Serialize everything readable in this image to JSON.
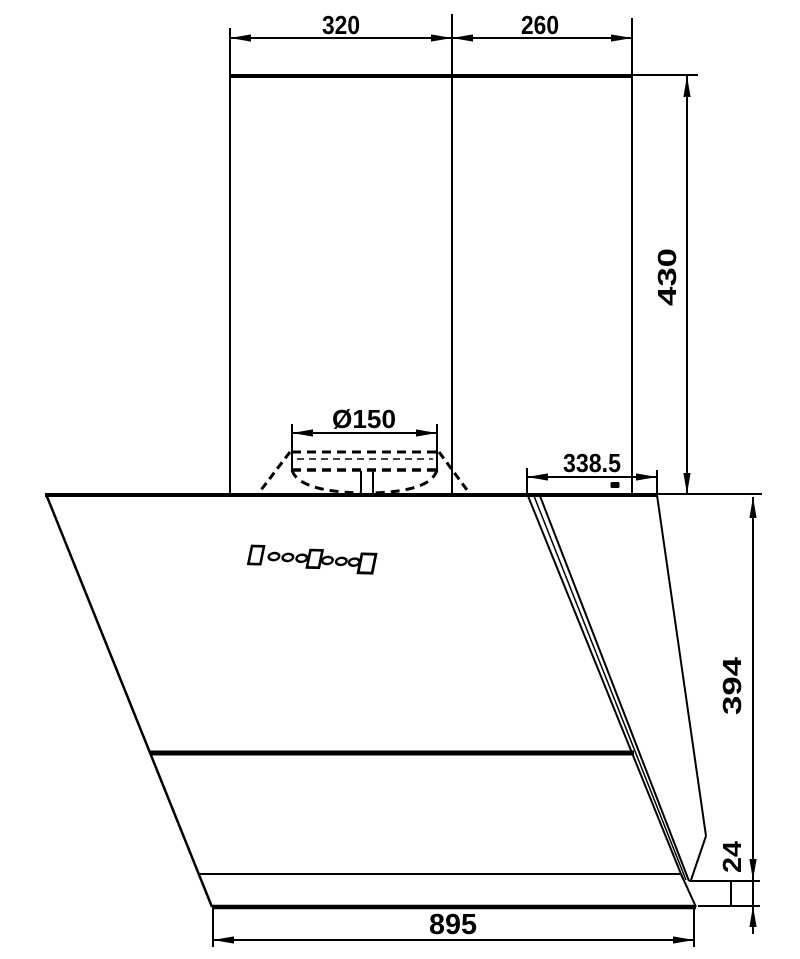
{
  "page": {
    "background_color": "#ffffff",
    "line_color": "#000000"
  },
  "dimensions": {
    "chimney_front_width": {
      "value": "320"
    },
    "chimney_rear_width": {
      "value": "260"
    },
    "chimney_height": {
      "value": "430"
    },
    "duct_diameter": {
      "value": "Ø150"
    },
    "top_depth": {
      "value": "338.5"
    },
    "body_height": {
      "value": "394"
    },
    "base_thickness": {
      "value": "24"
    },
    "overall_width": {
      "value": "895"
    }
  },
  "control_panel": {
    "glyphs": [
      "button",
      "led",
      "led",
      "led",
      "button",
      "led",
      "led",
      "led",
      "button"
    ]
  }
}
